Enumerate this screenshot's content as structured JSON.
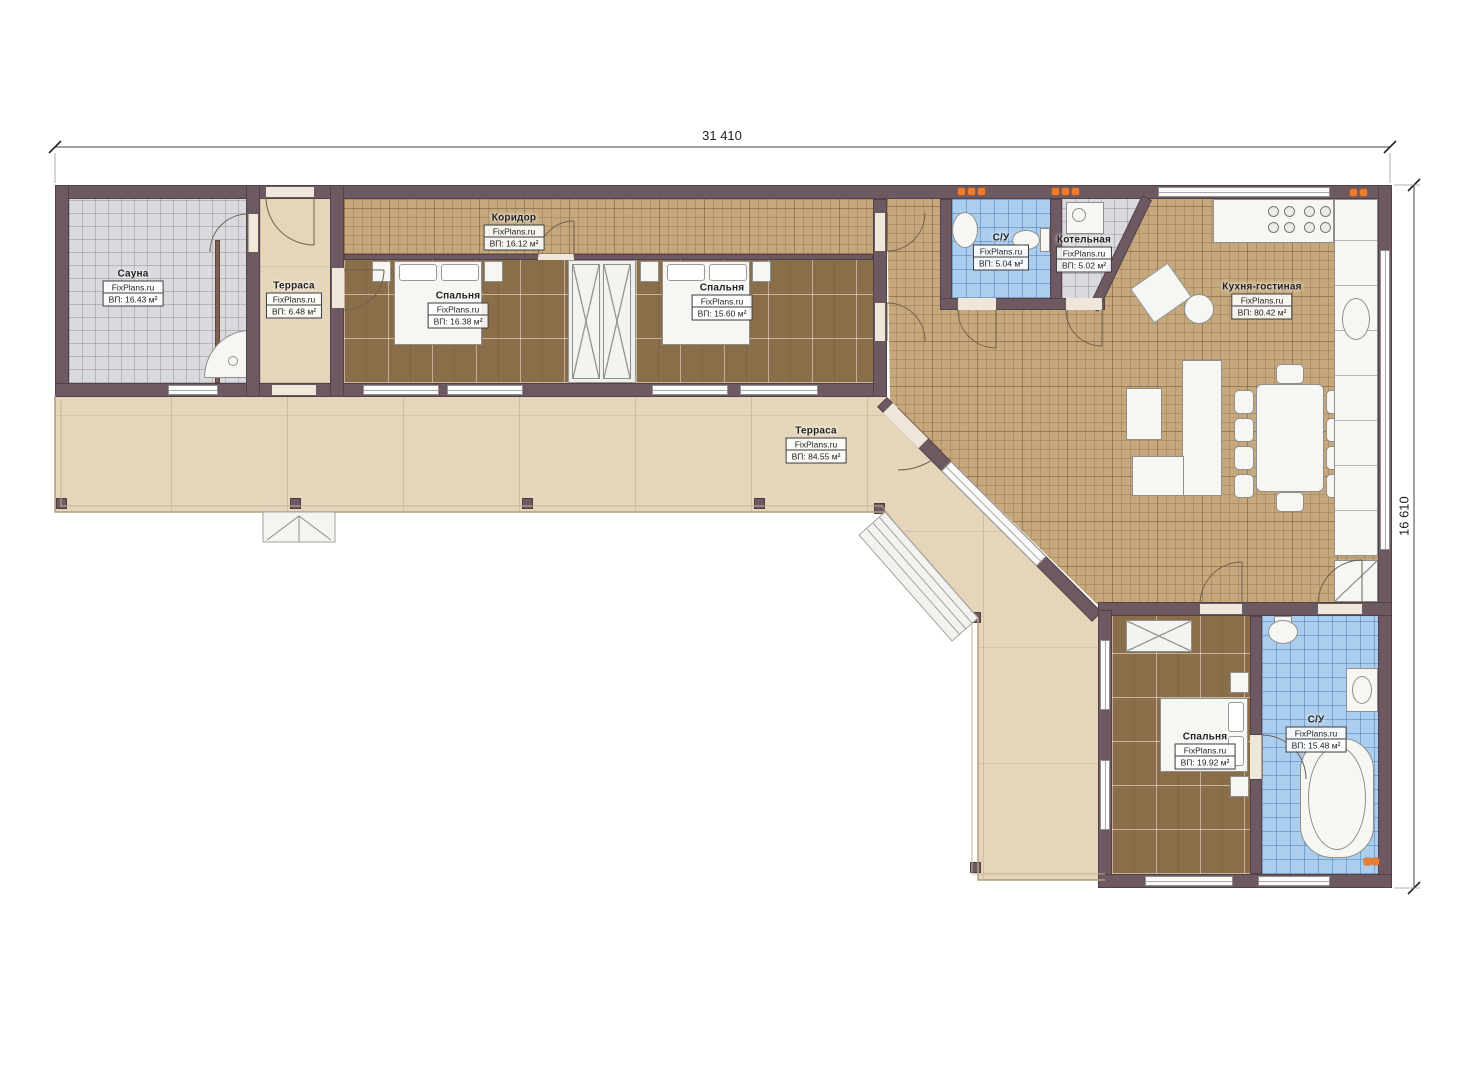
{
  "plan": {
    "brand": "FixPlans.ru",
    "dimensions": {
      "width": "31 410",
      "height": "16 610"
    },
    "rooms": [
      {
        "key": "sauna",
        "name": "Сауна",
        "brand": "FixPlans.ru",
        "area": "ВП: 16.43 м²"
      },
      {
        "key": "terrace_small",
        "name": "Терраса",
        "brand": "FixPlans.ru",
        "area": "ВП: 6.48 м²"
      },
      {
        "key": "corridor",
        "name": "Коридор",
        "brand": "FixPlans.ru",
        "area": "ВП: 16.12 м²"
      },
      {
        "key": "bedroom1",
        "name": "Спальня",
        "brand": "FixPlans.ru",
        "area": "ВП: 16.38 м²"
      },
      {
        "key": "bedroom2",
        "name": "Спальня",
        "brand": "FixPlans.ru",
        "area": "ВП: 15.60 м²"
      },
      {
        "key": "wc_top",
        "name": "С/У",
        "brand": "FixPlans.ru",
        "area": "ВП: 5.04 м²"
      },
      {
        "key": "boiler",
        "name": "Котельная",
        "brand": "FixPlans.ru",
        "area": "ВП: 5.02 м²"
      },
      {
        "key": "kitchen_living",
        "name": "Кухня-гостиная",
        "brand": "FixPlans.ru",
        "area": "ВП: 80.42 м²"
      },
      {
        "key": "terrace_big",
        "name": "Терраса",
        "brand": "FixPlans.ru",
        "area": "ВП: 84.55 м²"
      },
      {
        "key": "bedroom3",
        "name": "Спальня",
        "brand": "FixPlans.ru",
        "area": "ВП: 19.92 м²"
      },
      {
        "key": "wc_bottom",
        "name": "С/У",
        "brand": "FixPlans.ru",
        "area": "ВП: 15.48 м²"
      }
    ],
    "colors": {
      "wall": "#6d5961",
      "floor_tan": "#c6a87c",
      "floor_brown": "#8a6e49",
      "floor_grey": "#dadade",
      "floor_blue": "#abceef",
      "terrace": "#e5d6bb",
      "accent_orange": "#ed7d2b"
    }
  }
}
